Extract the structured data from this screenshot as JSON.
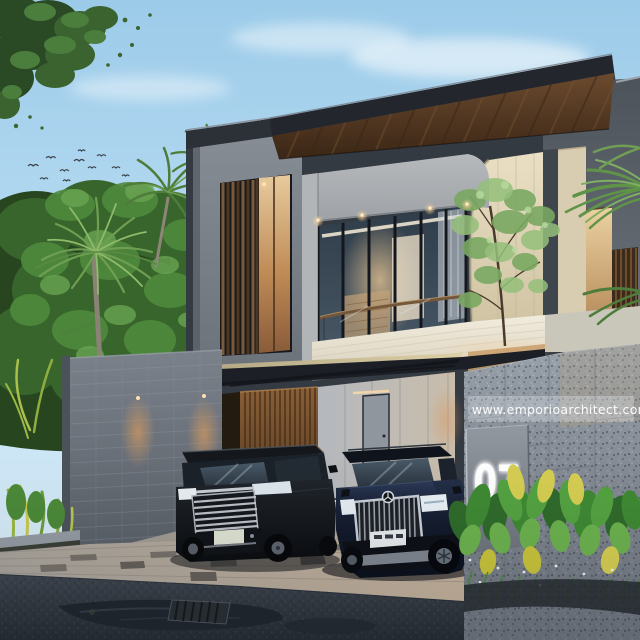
{
  "meta": {
    "kind": "architectural-exterior-render",
    "time_of_day": "dusk",
    "subject": "modern two-storey tropical house with carport, two luxury cars and granite gate pillar"
  },
  "watermark": {
    "text": "www.emporioarchitect.com"
  },
  "address_sign": {
    "number": "07"
  },
  "scene": {
    "elements": [
      "sky",
      "clouds",
      "bird-flock",
      "overhanging-tree",
      "background-trees",
      "coconut-palms",
      "fan-palm",
      "flat-roof-wood-soffit",
      "concrete-tower",
      "louvered-window",
      "balcony-glass-wall",
      "glass-railing",
      "white-stone-parapet",
      "cream-travertine-wall",
      "facade-tree",
      "lit-wall-recess",
      "carport-canopy",
      "wood-slat-wall",
      "concrete-panel-wall",
      "carport-door",
      "boundary-block-wall",
      "wall-wash-lights",
      "mpv-car",
      "suv-car",
      "granite-gate-pillar",
      "watermark-strip",
      "address-sign-panel",
      "tropical-plants",
      "paver-driveway",
      "asphalt-road",
      "puddle",
      "drain-grate",
      "right-palm-fronds"
    ]
  },
  "palette": {
    "sky_top": "#9ccbe9",
    "sky_low": "#e6f2fa",
    "foliage_dark": "#27461f",
    "foliage_mid": "#3c6a30",
    "foliage_light": "#6fa050",
    "roof_fascia": "#23272d",
    "wood_soffit": "#583b25",
    "concrete_light": "#b3b6b9",
    "concrete_mid": "#828890",
    "cream_stone": "#e6dcc1",
    "parapet_white": "#f0ead9",
    "glass": "#33414f",
    "interior_warm": "#e9c288",
    "louver_wood": "#7d5a38",
    "canopy": "#1d2127",
    "block_wall": "#6f757d",
    "warm_light": "#d89a5e",
    "granite": "#99a1ab",
    "sign_panel": "#7e848c",
    "sign_number": "#ffffff",
    "plant_green": "#3f7a33",
    "plant_yellow": "#cfc93e",
    "paver": "#b3ada4",
    "asphalt": "#363d45",
    "puddle": "#20262d",
    "car_mpv": "#15181d",
    "car_suv": "#1a2335",
    "chrome": "#c9ced5"
  }
}
